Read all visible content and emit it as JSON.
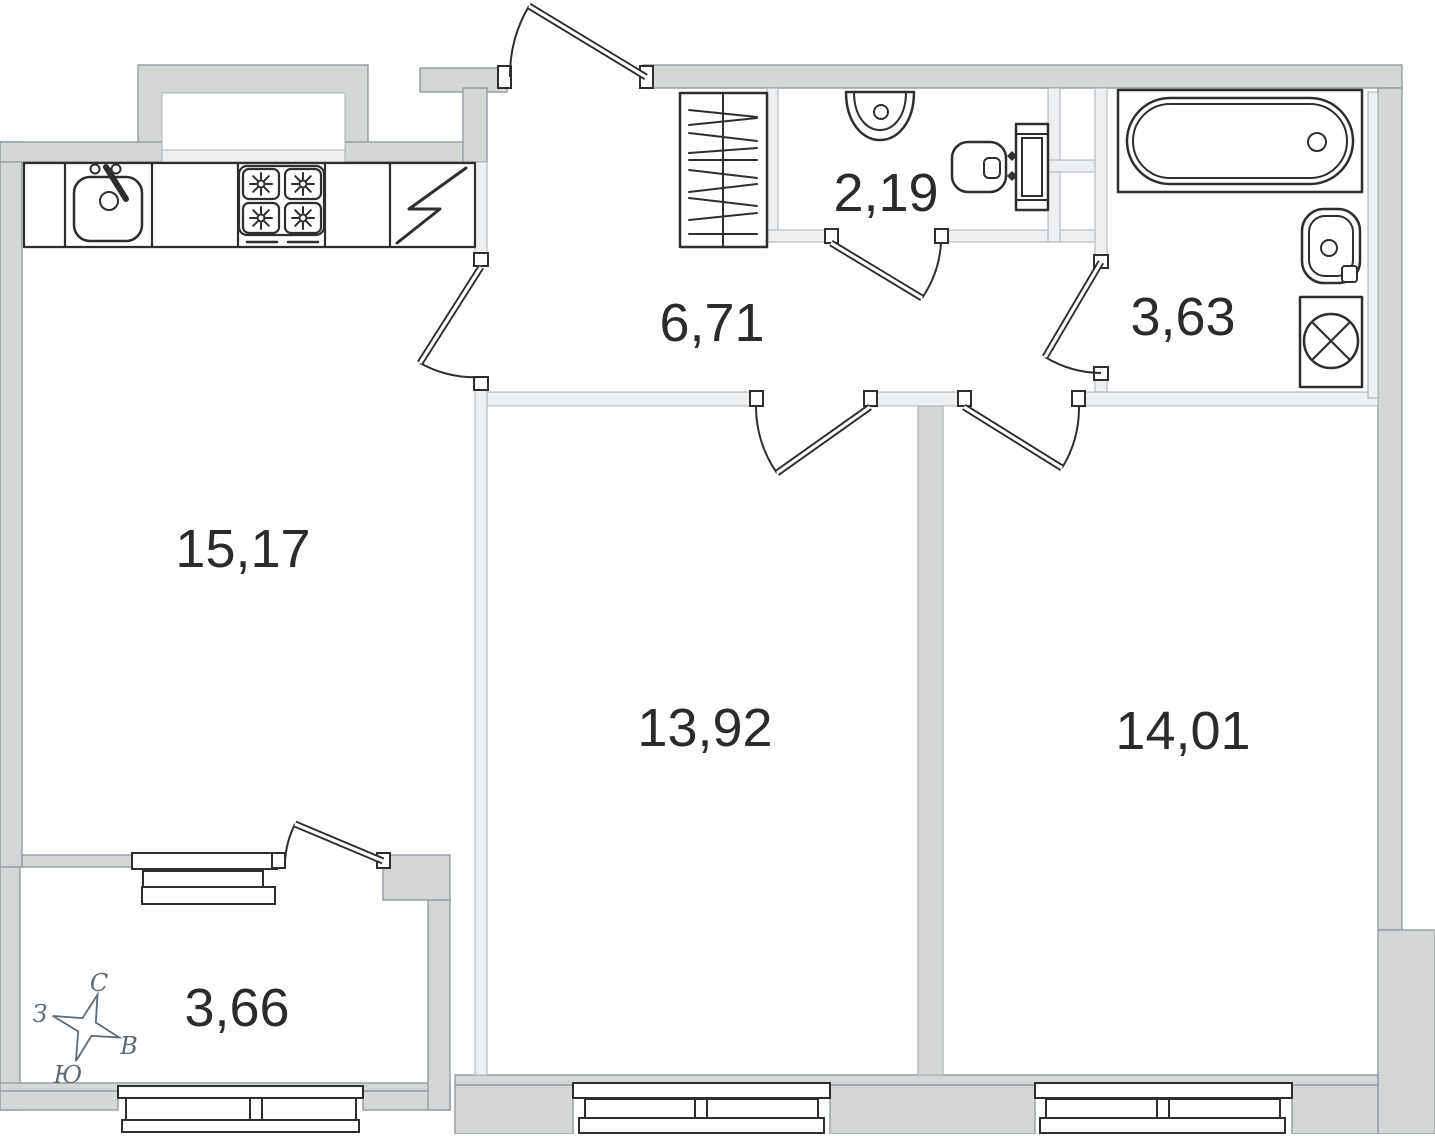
{
  "plan": {
    "kind": "apartment-floor-plan",
    "language": "ru"
  },
  "rooms": {
    "kitchen_living": {
      "area": "15,17"
    },
    "hallway": {
      "area": "6,71"
    },
    "wc": {
      "area": "2,19"
    },
    "bathroom": {
      "area": "3,63"
    },
    "bedroom_1": {
      "area": "13,92"
    },
    "bedroom_2": {
      "area": "14,01"
    },
    "balcony": {
      "area": "3,66"
    }
  },
  "compass": {
    "north": "С",
    "west": "З",
    "east": "В",
    "south": "Ю"
  },
  "fixtures": [
    "kitchen-sink-icon",
    "stove-icon",
    "tall-cabinet-icon",
    "wardrobe-icon",
    "wc-sink-icon",
    "toilet-icon",
    "bathtub-icon",
    "washbasin-icon",
    "washing-machine-icon"
  ],
  "colors": {
    "wall_fill": "#d5d7d7",
    "wall_stroke": "#97a1a9",
    "partition_fill": "#edeff0",
    "partition_stroke": "#a9b1b8",
    "line": "#2e2e2e",
    "label": "#2b2b2b",
    "compass": "#5d6b76",
    "background": "#ffffff"
  }
}
